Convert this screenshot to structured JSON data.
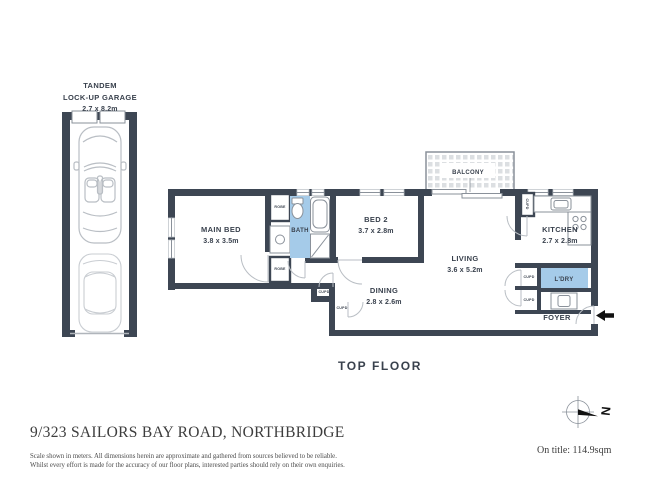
{
  "plan": {
    "garage": {
      "name_line1": "TANDEM",
      "name_line2": "LOCK-UP GARAGE",
      "dims": "2.7 x 8.2m"
    },
    "rooms": {
      "main_bed": {
        "name": "MAIN BED",
        "dims": "3.8 x 3.5m"
      },
      "bed2": {
        "name": "BED 2",
        "dims": "3.7 x 2.8m"
      },
      "bath": {
        "name": "BATH"
      },
      "living": {
        "name": "LIVING",
        "dims": "3.6 x 5.2m"
      },
      "dining": {
        "name": "DINING",
        "dims": "2.8 x 2.6m"
      },
      "kitchen": {
        "name": "KITCHEN",
        "dims": "2.7 x 2.8m"
      },
      "balcony": {
        "name": "BALCONY"
      },
      "laundry": {
        "name": "L'DRY"
      },
      "foyer": {
        "name": "FOYER"
      },
      "robe": "ROBE",
      "cupd": "CUPD"
    },
    "floor_label": "TOP FLOOR",
    "compass_north": "N"
  },
  "footer": {
    "address": "9/323 SAILORS BAY ROAD, NORTHBRIDGE",
    "area_on_title": "On title: 114.9sqm",
    "disclaimer_line1": "Scale shown in meters. All dimensions herein are approximate and gathered from sources believed to be reliable.",
    "disclaimer_line2": "Whilst every effort is made for the accuracy of our floor plans, interested parties should rely on their own enquiries."
  },
  "colors": {
    "wall": "#3d4653",
    "water_blue": "#a5cbe9",
    "line_light": "#b9bec4",
    "line_mid": "#8a919a",
    "text": "#39414d",
    "footer_text": "#3d3d3d",
    "tile": "#dcdfe2",
    "ink": "#111111"
  }
}
